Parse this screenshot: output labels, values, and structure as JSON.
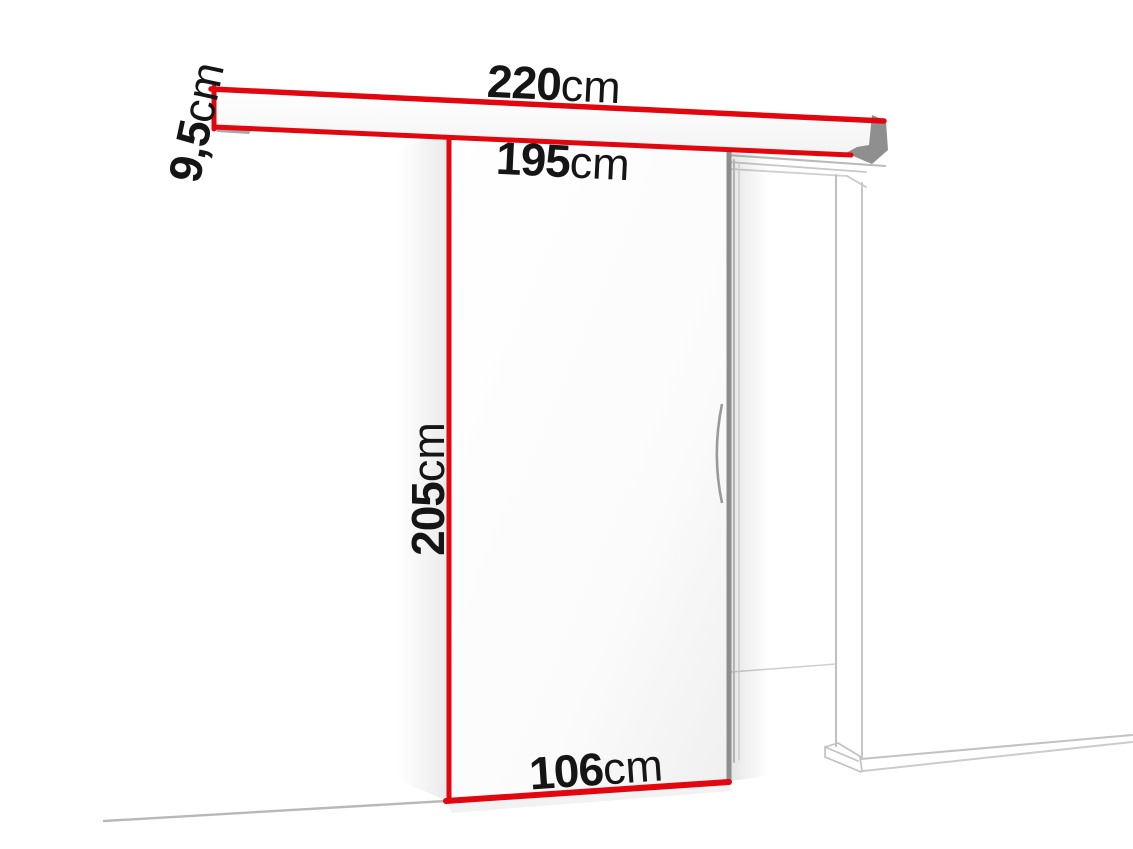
{
  "diagram": {
    "labels": {
      "rail_length": {
        "value": "220",
        "unit": "cm"
      },
      "track_length": {
        "value": "195",
        "unit": "cm"
      },
      "rail_height": {
        "value": "9,5",
        "unit": "cm"
      },
      "door_height": {
        "value": "205",
        "unit": "cm"
      },
      "door_width": {
        "value": "106",
        "unit": "cm"
      }
    },
    "colors": {
      "accent_red": "#e2070f",
      "door_edge_gray": "#8d8d8d",
      "frame_line_gray": "#c2c2c2",
      "text": "#151515",
      "background": "#ffffff"
    }
  }
}
